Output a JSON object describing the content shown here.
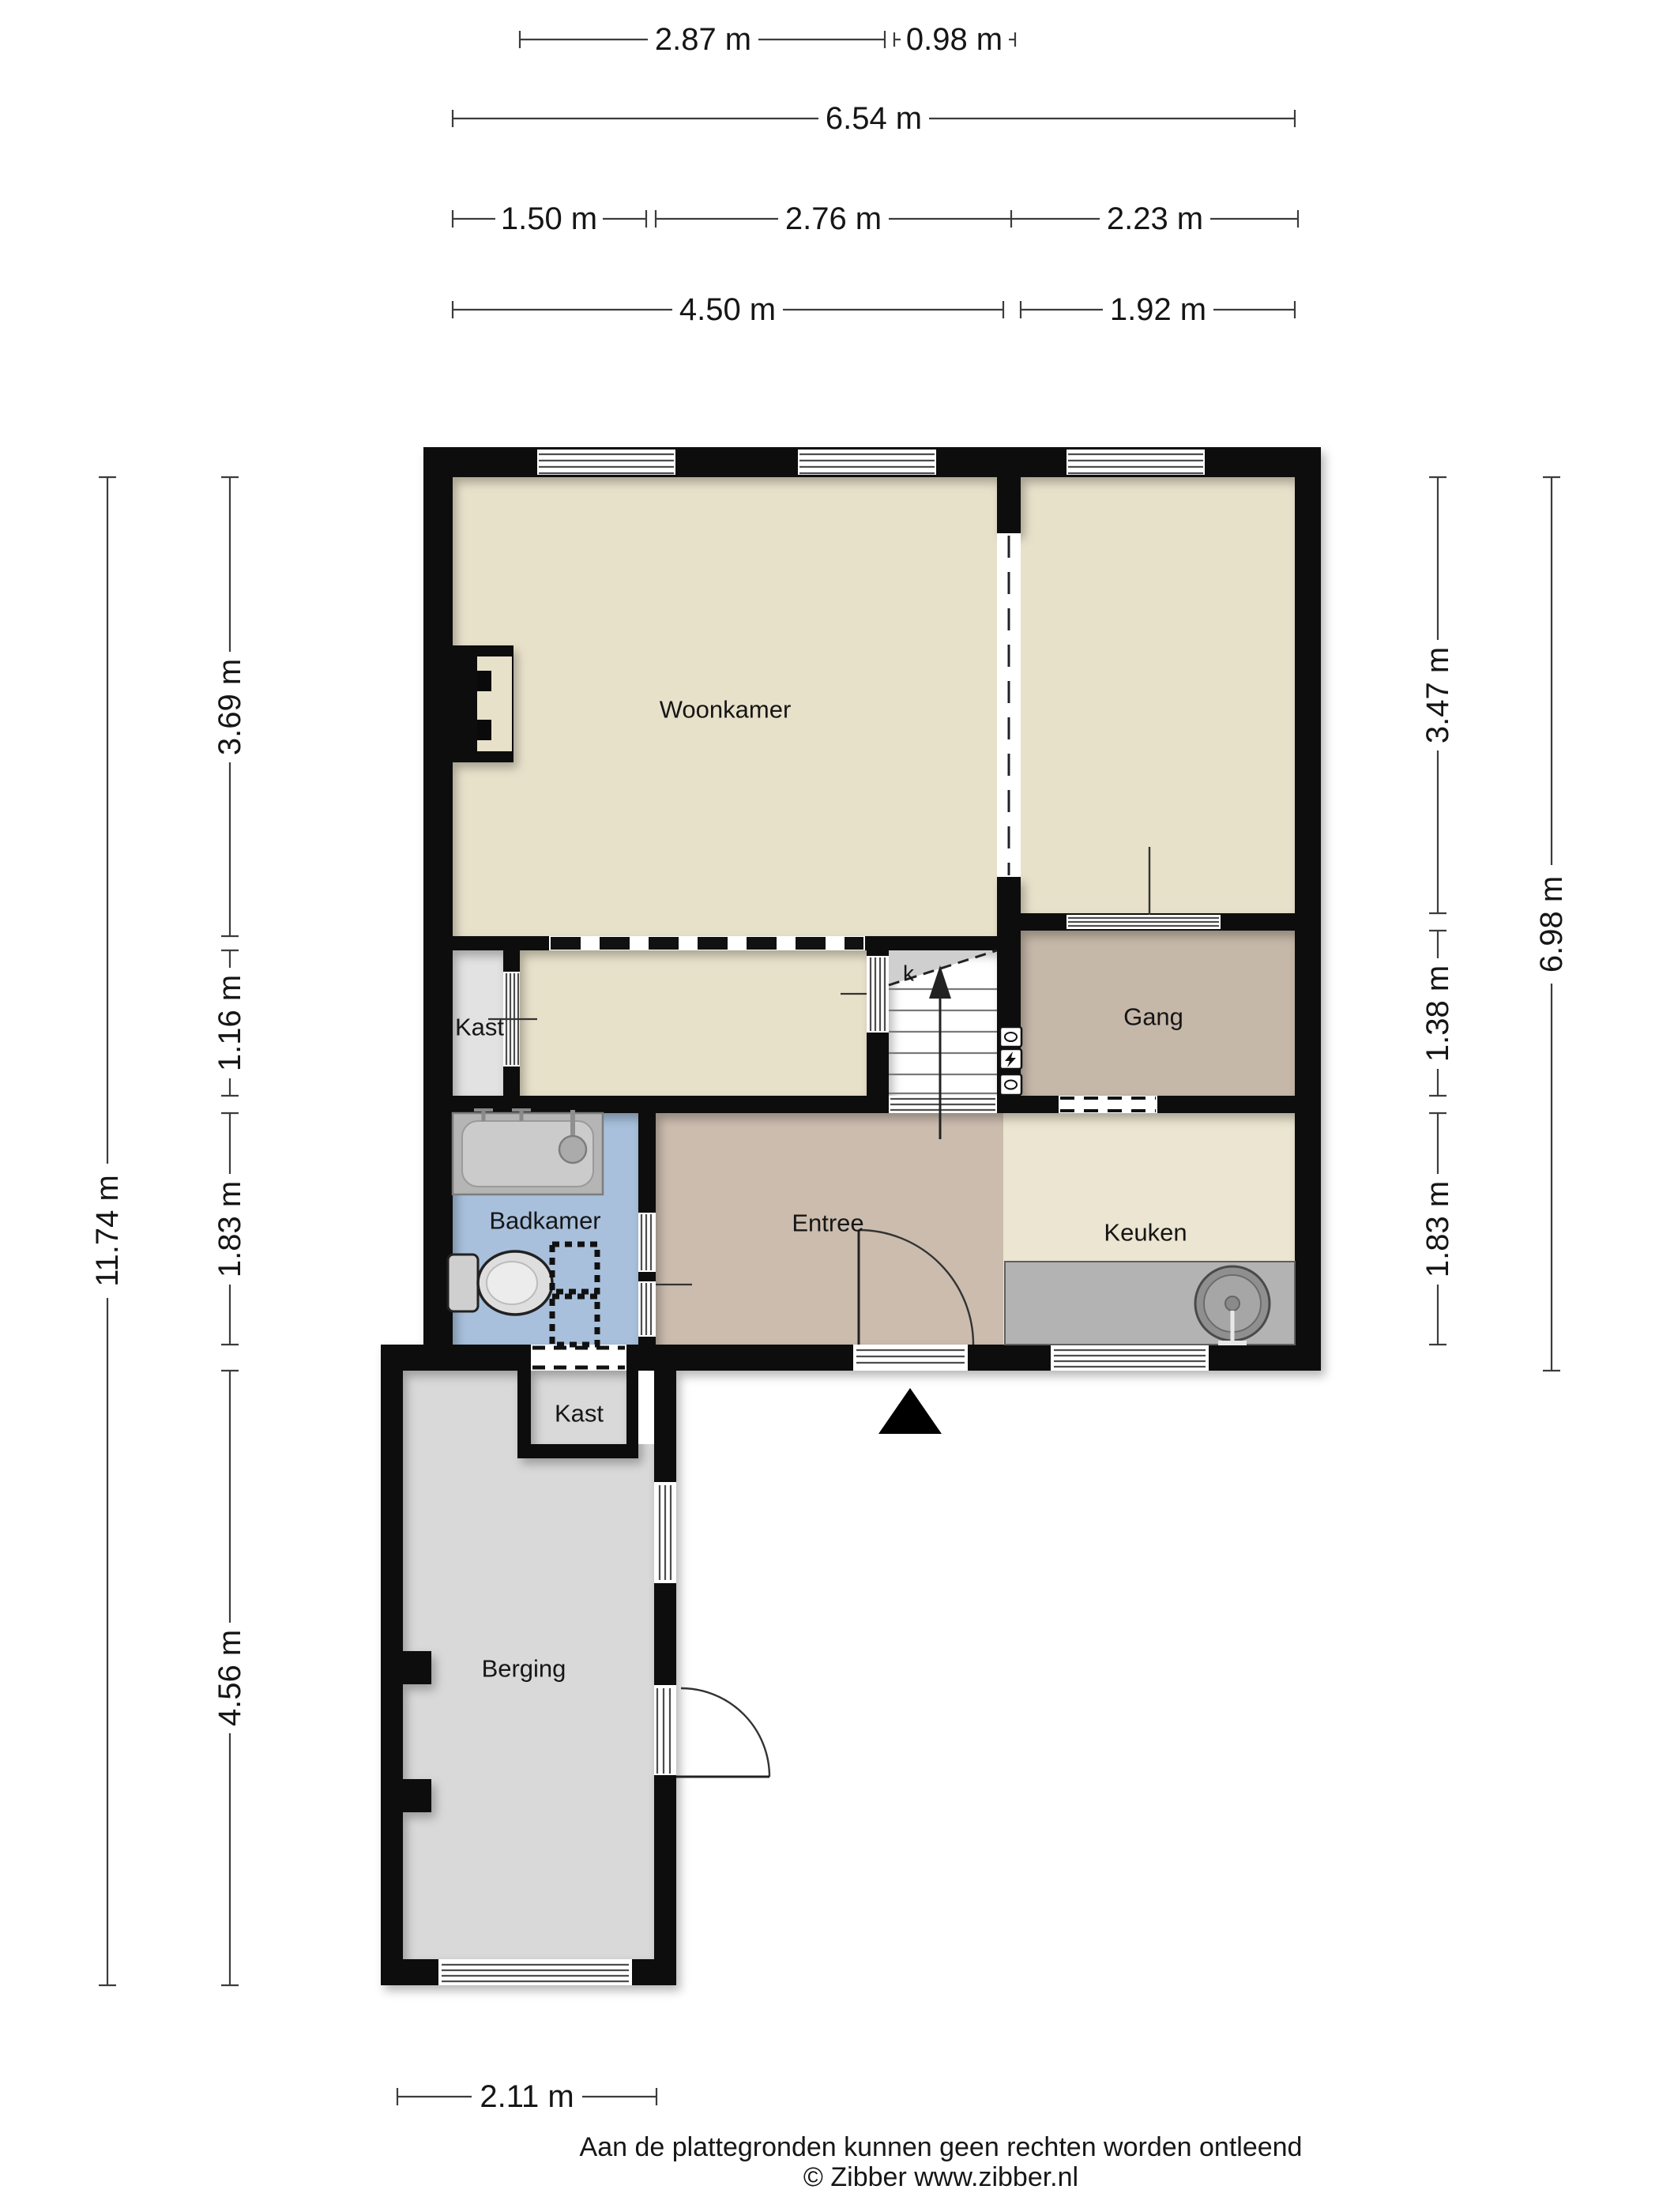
{
  "dimensions": {
    "row1": [
      {
        "label": "2.87 m"
      },
      {
        "label": "0.98 m"
      }
    ],
    "row2": [
      {
        "label": "6.54 m"
      }
    ],
    "row3": [
      {
        "label": "1.50 m"
      },
      {
        "label": "2.76 m"
      },
      {
        "label": "2.23 m"
      }
    ],
    "row4": [
      {
        "label": "4.50 m"
      },
      {
        "label": "1.92 m"
      }
    ],
    "left_outer": [
      {
        "label": "11.74 m"
      }
    ],
    "left_inner": [
      {
        "label": "3.69 m"
      },
      {
        "label": "1.16 m"
      },
      {
        "label": "1.83 m"
      },
      {
        "label": "4.56 m"
      }
    ],
    "right_inner": [
      {
        "label": "3.47 m"
      },
      {
        "label": "1.38 m"
      },
      {
        "label": "1.83 m"
      }
    ],
    "right_outer": [
      {
        "label": "6.98 m"
      }
    ],
    "bottom": [
      {
        "label": "2.11 m"
      }
    ]
  },
  "rooms": {
    "woonkamer": {
      "label": "Woonkamer"
    },
    "kast_middle": {
      "label": "Kast"
    },
    "gang": {
      "label": "Gang"
    },
    "badkamer": {
      "label": "Badkamer"
    },
    "entree": {
      "label": "Entree"
    },
    "keuken": {
      "label": "Keuken"
    },
    "kast_berging": {
      "label": "Kast"
    },
    "berging": {
      "label": "Berging"
    },
    "stair_closet": {
      "label": "k"
    }
  },
  "footer": {
    "disclaimer": "Aan de plattegronden kunnen geen rechten worden ontleend",
    "copyright": "© Zibber www.zibber.nl"
  },
  "colors": {
    "wall": "#0a0a0a",
    "floor_beige": "#e8e1ca",
    "floor_keuken": "#ebe5d1",
    "floor_gang": "#c6b8a8",
    "floor_entree": "#cbbcae",
    "floor_badkamer": "#a8c0dc",
    "floor_kast": "#e2e2e2",
    "floor_berging": "#d9d9d9",
    "counter": "#b3b3b3",
    "understairs": "#cfcfcf",
    "niche": "#e8e1ca"
  }
}
